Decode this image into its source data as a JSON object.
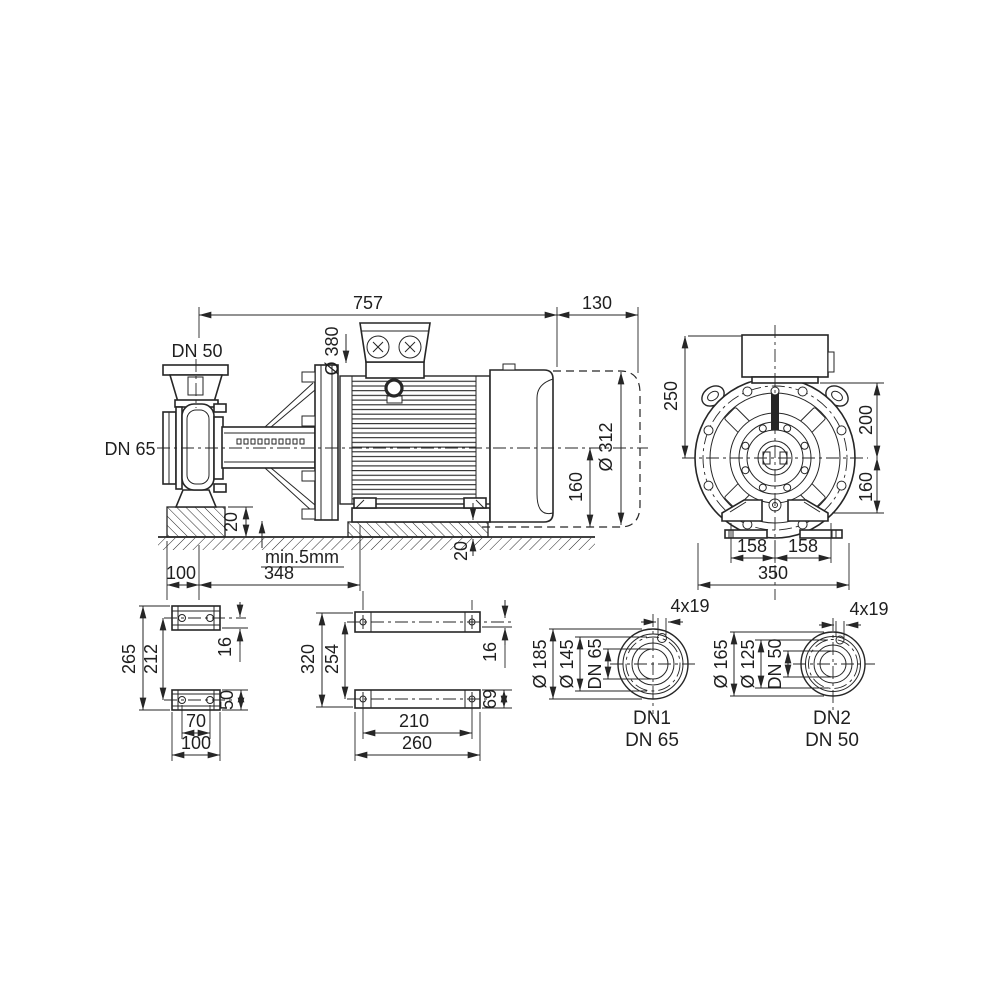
{
  "drawing": {
    "side_view": {
      "total_length": "757",
      "dismantling_space": "130",
      "flange_diameter": "Ø 380",
      "discharge_label": "DN 50",
      "suction_label": "DN 65",
      "pump_foundation_height": "20",
      "grout_gap": "min.5mm",
      "foot_offset": "100",
      "foot_distance": "348",
      "motor_foundation_height": "20",
      "shaft_height": "160",
      "motor_diameter": "Ø 312"
    },
    "front_view": {
      "height_above_center": "250",
      "box_height_above_center": "200",
      "shaft_height": "160",
      "foot_left": "158",
      "foot_right": "158",
      "overall_width": "350"
    },
    "pump_foot_view": {
      "overall_height": "265",
      "hole_spacing": "212",
      "plate_thickness": "16",
      "foot_height": "50",
      "hole_width": "70",
      "foot_width": "100"
    },
    "motor_foot_view": {
      "overall_height": "320",
      "hole_spacing": "254",
      "plate_thickness": "16",
      "rail_height": "69",
      "hole_width": "210",
      "rail_width": "260"
    },
    "flange_dn1": {
      "bolt_holes": "4x19",
      "outer_diameter": "Ø 185",
      "bolt_circle": "Ø 145",
      "bore": "DN 65",
      "name": "DN1",
      "size": "DN 65"
    },
    "flange_dn2": {
      "bolt_holes": "4x19",
      "outer_diameter": "Ø 165",
      "bolt_circle": "Ø 125",
      "bore": "DN 50",
      "name": "DN2",
      "size": "DN 50"
    },
    "colors": {
      "line": "#262626",
      "background": "#ffffff"
    }
  }
}
